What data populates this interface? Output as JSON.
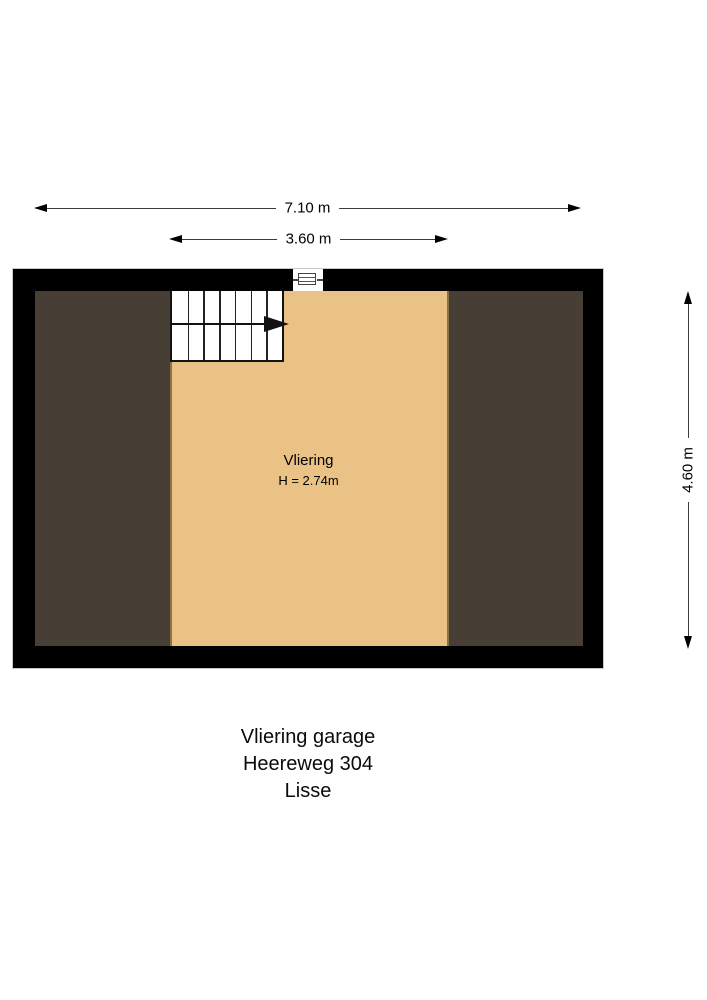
{
  "dimensions": {
    "total_width": {
      "label": "7.10 m"
    },
    "attic_width": {
      "label": "3.60 m"
    },
    "total_depth": {
      "label": "4.60 m"
    }
  },
  "plan": {
    "room": {
      "name": "Vliering",
      "ceiling_height": "H = 2.74m"
    }
  },
  "title_block": {
    "line1": "Vliering garage",
    "line2": "Heereweg 304",
    "line3": "Lisse"
  },
  "colors": {
    "wall": "#000000",
    "attic_floor": "#ebc286",
    "under_roof_area": "#473f35",
    "zone_divider": "#8b7147",
    "background": "#ffffff"
  },
  "icons": {
    "stair_direction": "right-pointing solid triangle",
    "window": "lined rectangle in wall opening",
    "dimension_arrows": "thin double-headed arrows"
  }
}
